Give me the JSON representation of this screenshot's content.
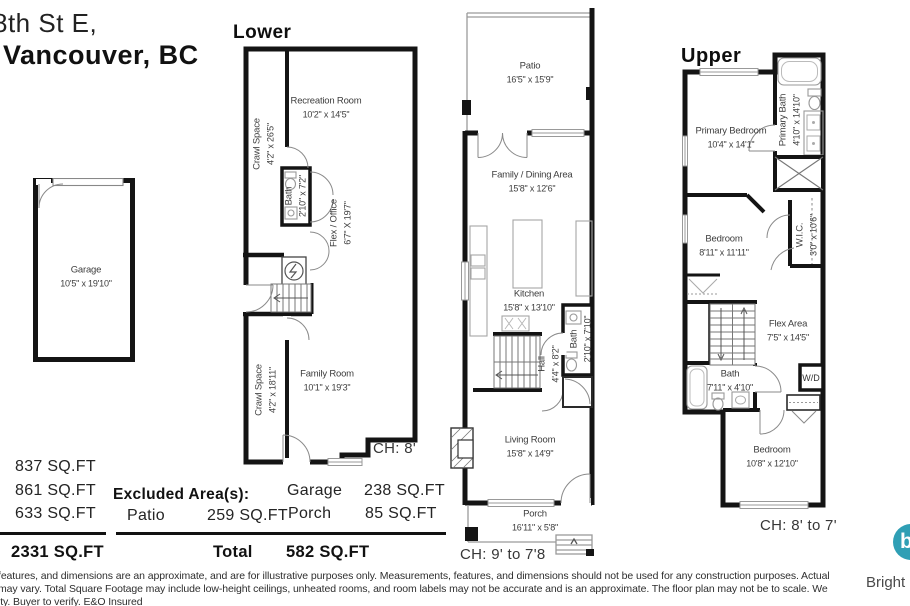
{
  "address": {
    "line1": "8th St E,",
    "line2": "Vancouver, BC"
  },
  "plans": {
    "garage": {
      "room": {
        "name": "Garage",
        "dims": "10'5\" x 19'10\""
      }
    },
    "lower": {
      "title": "Lower",
      "ceiling_height": "CH: 8'",
      "rooms": {
        "recreation": {
          "name": "Recreation Room",
          "dims": "10'2\" x 14'5\""
        },
        "crawl_top": {
          "name": "Crawl Space",
          "dims": "4'2\" x 26'5\""
        },
        "bath": {
          "name": "Bath",
          "dims": "2'10\" x 7'2\""
        },
        "flex_office": {
          "name": "Flex / Office",
          "dims": "6'7\" X 19'7\""
        },
        "family": {
          "name": "Family Room",
          "dims": "10'1\" x 19'3\""
        },
        "crawl_bottom": {
          "name": "Crawl Space",
          "dims": "4'2\" x 18'11\""
        }
      }
    },
    "main": {
      "title": "Main",
      "ceiling_height": "CH: 9' to 7'8",
      "rooms": {
        "patio": {
          "name": "Patio",
          "dims": "16'5\" x 15'9\""
        },
        "family_dining": {
          "name": "Family / Dining Area",
          "dims": "15'8\" x 12'6\""
        },
        "kitchen": {
          "name": "Kitchen",
          "dims": "15'8\" x 13'10\""
        },
        "hall": {
          "name": "Hall",
          "dims": "4'4\" x 8'2\""
        },
        "bath": {
          "name": "Bath",
          "dims": "2'10\" x 7'10\""
        },
        "living": {
          "name": "Living Room",
          "dims": "15'8\" x 14'9\""
        },
        "porch": {
          "name": "Porch",
          "dims": "16'11\" x 5'8\""
        }
      }
    },
    "upper": {
      "title": "Upper",
      "ceiling_height": "CH: 8' to 7'",
      "rooms": {
        "primary_bedroom": {
          "name": "Primary Bedroom",
          "dims": "10'4\" x 14'1\""
        },
        "primary_bath": {
          "name": "Primary Bath",
          "dims": "4'10\" x 14'10\""
        },
        "bedroom_mid": {
          "name": "Bedroom",
          "dims": "8'11\" x 11'11\""
        },
        "wic": {
          "name": "W.I.C.",
          "dims": "3'0\" x 10'6\""
        },
        "flex_area": {
          "name": "Flex Area",
          "dims": "7'5\" x 14'5\""
        },
        "bath": {
          "name": "Bath",
          "dims": "7'11\" x 4'10\""
        },
        "washer_dryer": {
          "name": "W/D"
        },
        "bedroom_rear": {
          "name": "Bedroom",
          "dims": "10'8\" x 12'10\""
        }
      }
    }
  },
  "areas": {
    "floor_sqft": [
      "837 SQ.FT",
      "861 SQ.FT",
      "633 SQ.FT"
    ],
    "total_sqft": "2331 SQ.FT",
    "excluded_title": "Excluded Area(s):",
    "excluded": [
      {
        "label": "Patio",
        "value": "259 SQ.FT"
      },
      {
        "label": "Garage",
        "value": "238 SQ.FT"
      },
      {
        "label": "Porch",
        "value": "85 SQ.FT"
      }
    ],
    "excluded_total_label": "Total",
    "excluded_total_value": "582 SQ.FT"
  },
  "disclaimer": {
    "line1": "features, and dimensions are an approximate, and are for illustrative purposes only. Measurements, features, and dimensions should not be used for any construction purposes. Actual",
    "line2": "may vary. Total Square Footage may include low-height ceilings, unheated rooms, and room labels may not be accurate and is an approximate. The floor plan may not be to scale. We",
    "line3": "ity. Buyer to verify. E&O Insured"
  },
  "branding": {
    "logo_text": "Bright",
    "logo_letter": "b",
    "logo_color": "#2f9fb5"
  },
  "colors": {
    "walls": "#141414"
  }
}
